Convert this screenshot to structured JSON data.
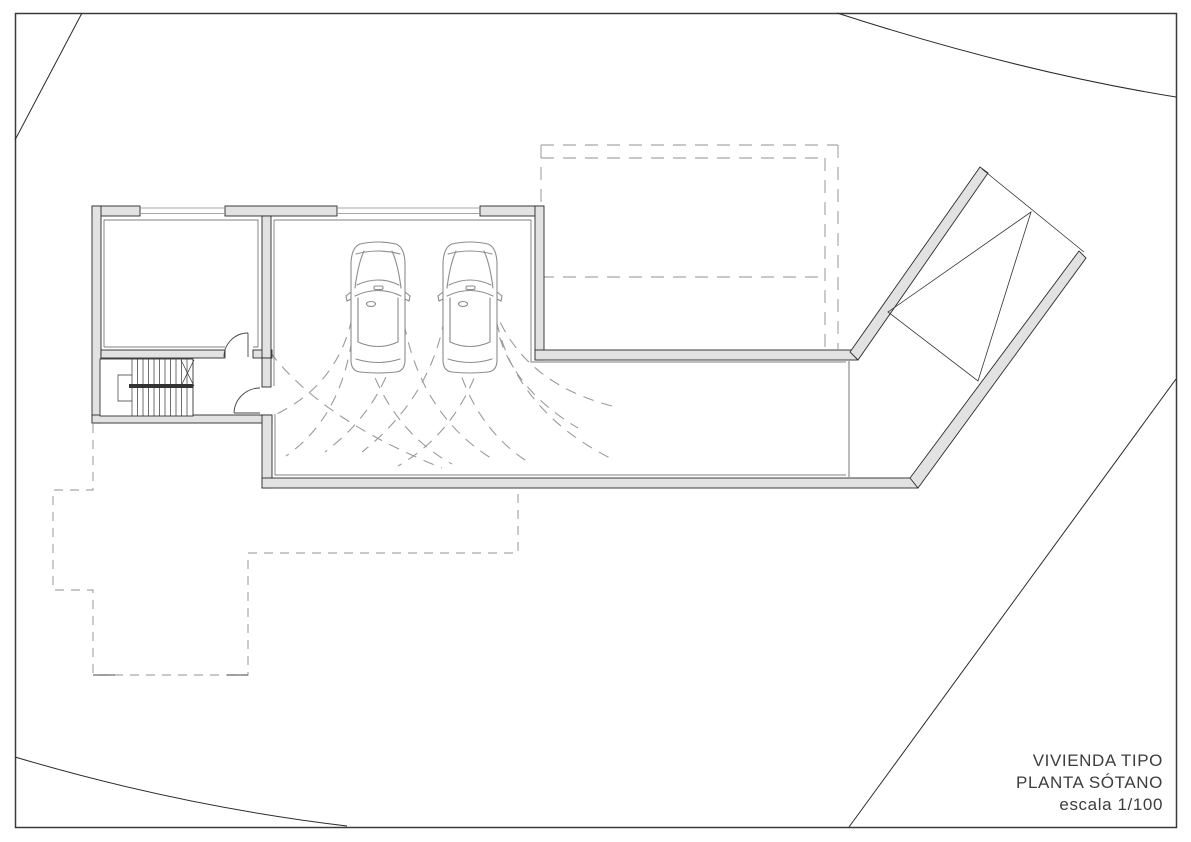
{
  "title_block": {
    "line1": "VIVIENDA TIPO",
    "line2": "PLANTA SÓTANO",
    "line3": "escala 1/100"
  },
  "plan": {
    "type": "architectural-floor-plan",
    "cars_count": 2,
    "components": [
      {
        "icon": "car-top-view-icon",
        "count": 2
      },
      {
        "icon": "staircase-icon",
        "count": 1
      },
      {
        "icon": "door-swing-icon",
        "count": 2
      },
      {
        "icon": "window-icon",
        "count": 2
      },
      {
        "icon": "ramp-icon",
        "count": 1
      },
      {
        "icon": "turning-path-arcs-icon",
        "count": 1
      },
      {
        "icon": "upper-floor-projection-dashed-icon",
        "count": 1
      },
      {
        "icon": "site-boundary-line-icon",
        "count": 4
      }
    ]
  },
  "colors": {
    "background": "#ffffff",
    "wall_fill": "#e2e2e2",
    "wall_stroke": "#2b2b2b",
    "dashed_line": "#a8a8a8",
    "arc_line": "#9b9b9b",
    "car_line": "#8d8d8d",
    "site_line": "#2a2a2a",
    "text": "#3d3d3d"
  }
}
